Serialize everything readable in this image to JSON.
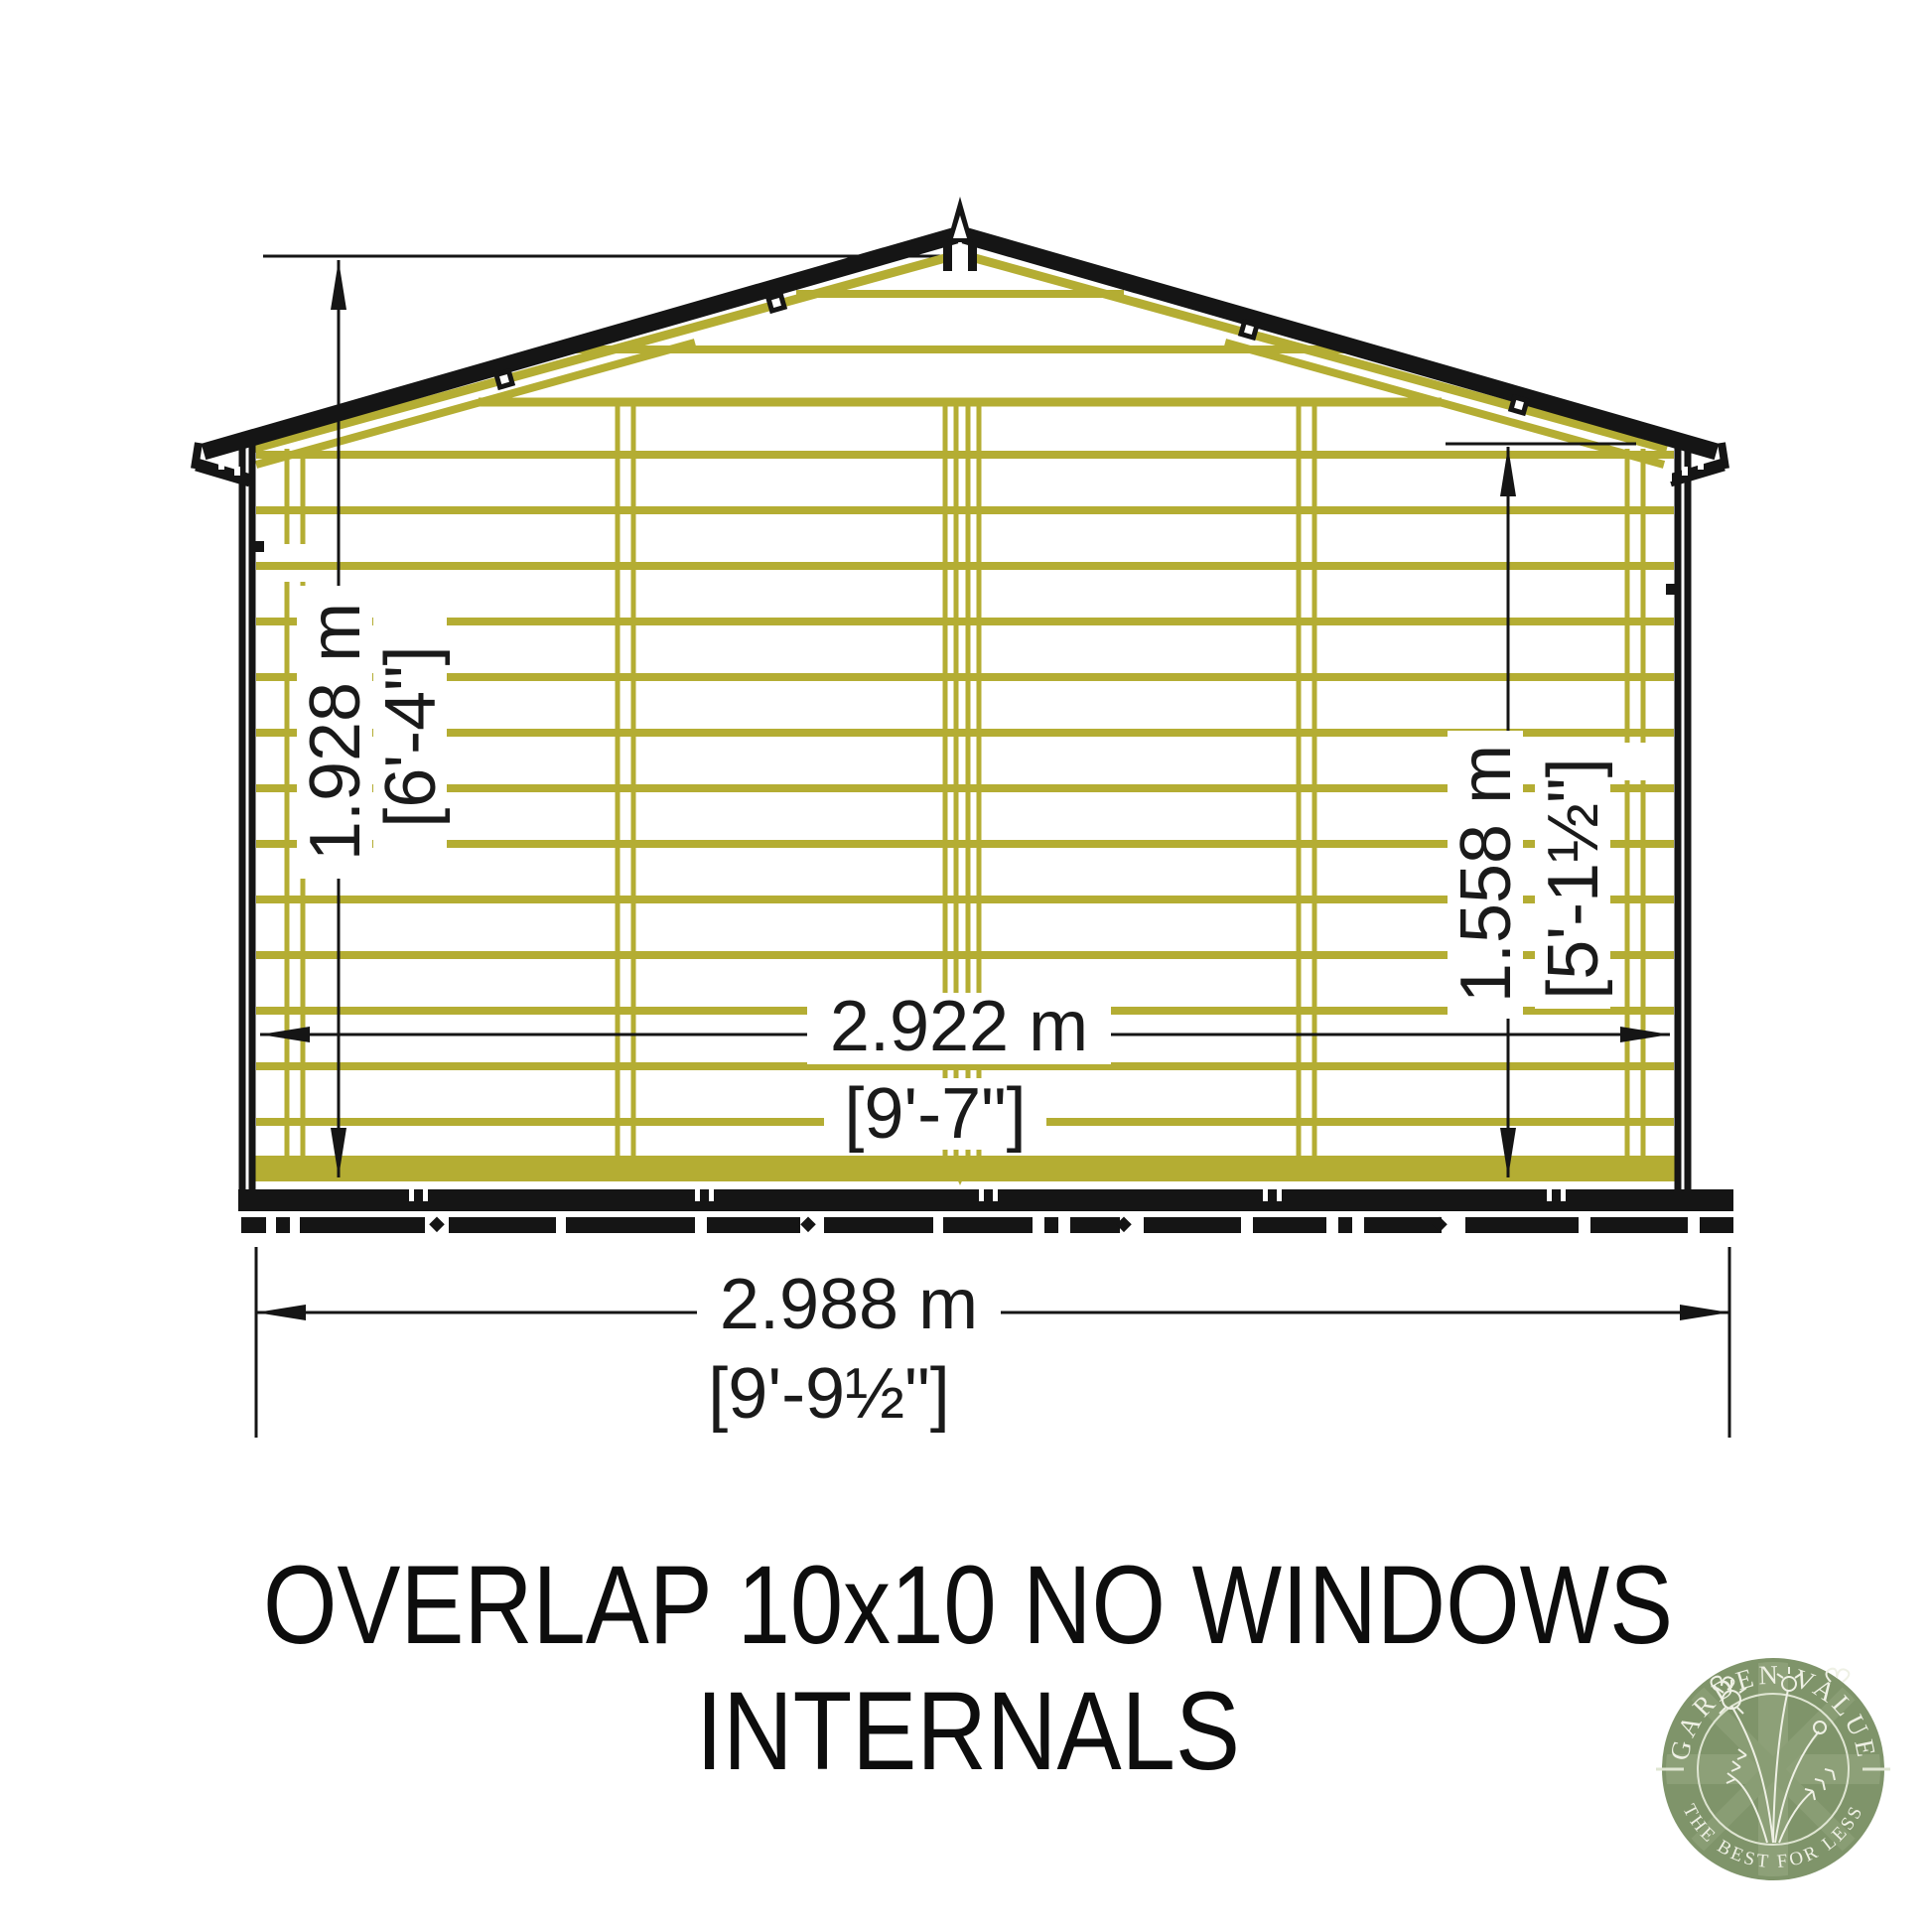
{
  "title": {
    "line1": "OVERLAP 10x10 NO WINDOWS",
    "line2": "INTERNALS"
  },
  "dimensions": {
    "ridge_height": {
      "metric": "1.928 m",
      "imperial": "[6'-4\"]"
    },
    "eaves_height": {
      "metric": "1.558 m",
      "imperial": "[5'-1½\"]"
    },
    "internal_width": {
      "metric": "2.922 m",
      "imperial": "[9'-7\"]"
    },
    "external_width": {
      "metric": "2.988 m",
      "imperial": "[9'-9½\"]"
    }
  },
  "logo": {
    "arc_top": "GARDEN VALUE",
    "arc_bottom": "THE BEST FOR LESS"
  },
  "colors": {
    "cladding": "#b4ad33",
    "outline": "#151515",
    "dimtext": "#1a1a1a",
    "logo-green": "#7f946a",
    "logo-flag": "#8d9f78",
    "logo-cream": "#eef0e4"
  }
}
